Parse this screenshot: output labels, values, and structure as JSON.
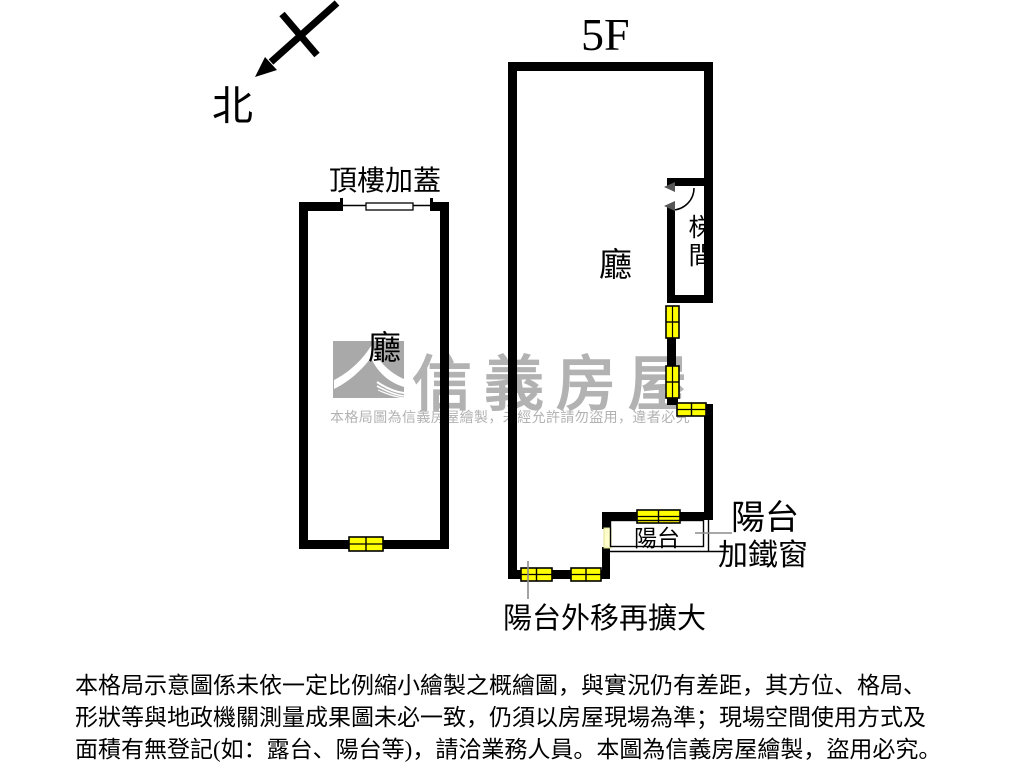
{
  "compass": {
    "label": "北"
  },
  "floor_label": "5F",
  "left_unit": {
    "title": "頂樓加蓋",
    "room_label": "廳"
  },
  "right_unit": {
    "room_label": "廳",
    "stair_label": "梯間",
    "balcony_label": "陽台",
    "callout_balcony_line1": "陽台",
    "callout_balcony_line2": "加鐵窗",
    "callout_bottom": "陽台外移再擴大"
  },
  "watermark": {
    "brand": "信義房屋",
    "notice": "本格局圖為信義房屋繪製，未經允許請勿盜用，違者必究",
    "logo": "sinyi-swoosh-logo"
  },
  "disclaimer": {
    "line1": "本格局示意圖係未依一定比例縮小繪製之概繪圖，與實況仍有差距，其方位、格局、",
    "line2": "形狀等與地政機關測量成果圖未必一致，仍須以房屋現場為準；現場空間使用方式及",
    "line3": "面積有無登記(如：露台、陽台等)，請洽業務人員。本圖為信義房屋繪製，盜用必究。"
  },
  "colors": {
    "wall_black": "#000000",
    "window_yellow": "#ffff00",
    "window_pale_yellow": "#ffffcc",
    "watermark_gray": "#b2b2b2",
    "logo_square_gray": "#a9a9a9",
    "callout_line_gray": "#8c8c8c",
    "background": "#ffffff"
  }
}
